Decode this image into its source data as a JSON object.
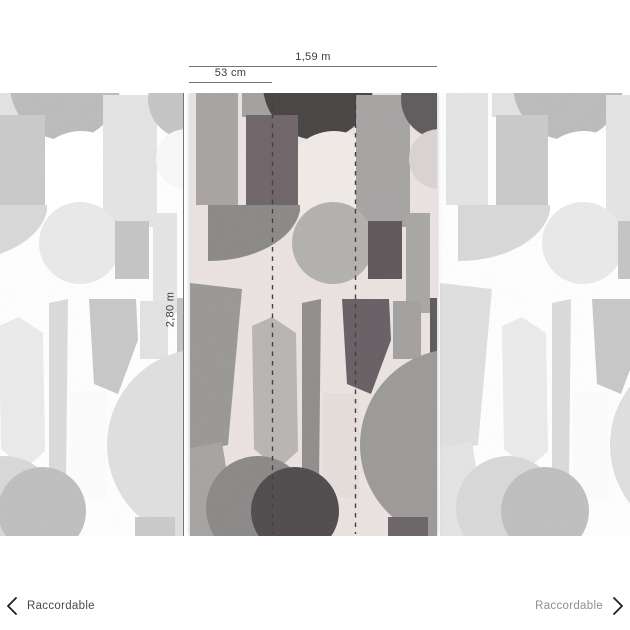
{
  "measurements": {
    "total_width": "1,59 m",
    "strip_width": "53 cm",
    "height": "2,80 m"
  },
  "footer": {
    "left": {
      "label": "Raccordable",
      "icon": "chevron-left"
    },
    "right": {
      "label": "Raccordable",
      "icon": "chevron-right"
    }
  },
  "colors": {
    "measure_line": "#757575",
    "measure_text": "#3d3d3d",
    "dash_line": "#434040",
    "chevron": "#1f1f1f",
    "footer_text_left": "#4a4a4a",
    "footer_text_right": "#8f8f8f",
    "page_background": "#ffffff"
  },
  "pattern": {
    "background": "#ebe3e1",
    "tile_width": 247,
    "tile_height": 443,
    "seam_positions": [
      272.5,
      355.5
    ],
    "shapes": [
      {
        "type": "rect",
        "x": 6,
        "y": 0,
        "w": 42,
        "h": 112,
        "fill": "#a7a4a3"
      },
      {
        "type": "rect",
        "x": 52,
        "y": 0,
        "w": 56,
        "h": 24,
        "fill": "#a3a1a0"
      },
      {
        "type": "circle",
        "cx": 128,
        "cy": -8,
        "r": 55,
        "fill": "#474343"
      },
      {
        "type": "circle",
        "cx": 144,
        "cy": 88,
        "r": 50,
        "fill": "#f1ebe8"
      },
      {
        "type": "rect",
        "x": 166,
        "y": 2,
        "w": 54,
        "h": 132,
        "fill": "#a6a4a3"
      },
      {
        "type": "circle",
        "cx": 251,
        "cy": 6,
        "r": 40,
        "fill": "#5f5a5b"
      },
      {
        "type": "circle",
        "cx": 249,
        "cy": 66,
        "r": 30,
        "fill": "#d9d4d2"
      },
      {
        "type": "rect",
        "x": 56,
        "y": 22,
        "w": 52,
        "h": 92,
        "fill": "#6f6468"
      },
      {
        "type": "path",
        "d": "M18,112 h92 v6 a92,58 0 0 1 -92,50 z",
        "fill": "#8b8987"
      },
      {
        "type": "circle",
        "cx": 143,
        "cy": 150,
        "r": 41,
        "fill": "#b3b1af"
      },
      {
        "type": "rect",
        "x": 178,
        "y": 128,
        "w": 34,
        "h": 58,
        "fill": "#5e575a"
      },
      {
        "type": "rect",
        "x": 216,
        "y": 120,
        "w": 24,
        "h": 100,
        "fill": "#a9a7a5"
      },
      {
        "type": "polygon",
        "points": "0,190 52,196 38,352 0,360",
        "fill": "#9a9896"
      },
      {
        "type": "polygon",
        "points": "62,233 82,224 106,240 108,358 88,376 64,356",
        "fill": "#b8b5b3"
      },
      {
        "type": "polygon",
        "points": "112,210 131,206 129,392 112,396",
        "fill": "#908e8c"
      },
      {
        "type": "polygon",
        "points": "152,206 199,206 201,247 181,301 157,291",
        "fill": "#665f63"
      },
      {
        "type": "rect",
        "x": 203,
        "y": 208,
        "w": 28,
        "h": 58,
        "fill": "#a3a1a0"
      },
      {
        "type": "rect",
        "x": 240,
        "y": 205,
        "w": 7,
        "h": 118,
        "fill": "#5f5a5b"
      },
      {
        "type": "circle",
        "cx": 266,
        "cy": 352,
        "r": 96,
        "fill": "#9c9a98"
      },
      {
        "type": "polygon",
        "points": "0,355 32,349 47,443 0,443",
        "fill": "#a6a4a2"
      },
      {
        "type": "rect",
        "x": 133,
        "y": 300,
        "w": 36,
        "h": 105,
        "fill": "#e6dedb"
      },
      {
        "type": "circle",
        "cx": 68,
        "cy": 415,
        "r": 52,
        "fill": "#8b8987"
      },
      {
        "type": "circle",
        "cx": 105,
        "cy": 418,
        "r": 44,
        "fill": "#4f4b4c"
      },
      {
        "type": "rect",
        "x": 198,
        "y": 424,
        "w": 40,
        "h": 19,
        "fill": "#6a6466"
      }
    ]
  }
}
